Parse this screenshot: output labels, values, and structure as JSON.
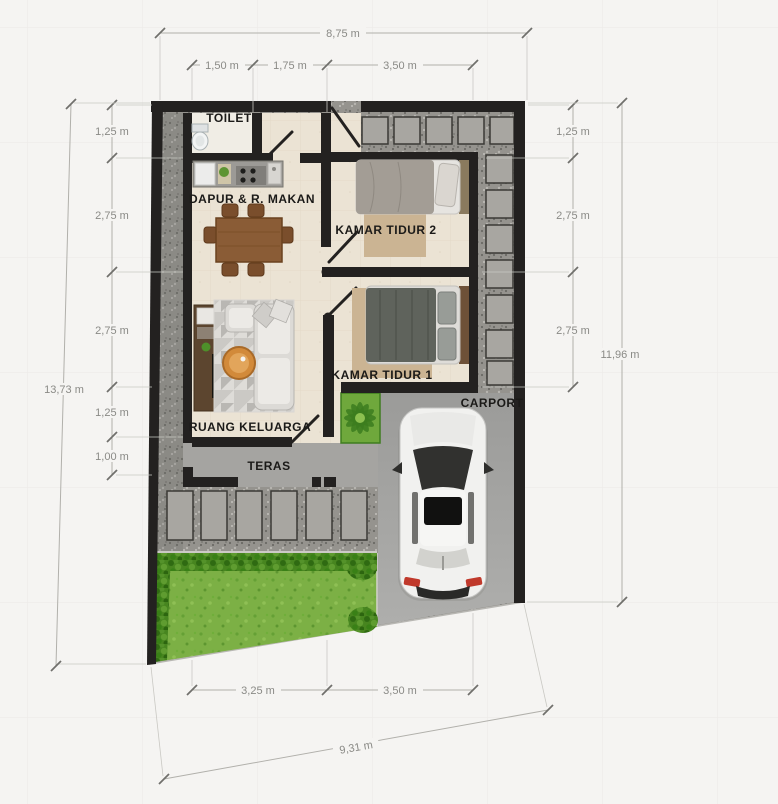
{
  "rooms": {
    "toilet": "TOILET",
    "kitchen_dining": "DAPUR & R. MAKAN",
    "bedroom2": "KAMAR TIDUR 2",
    "bedroom1": "KAMAR TIDUR 1",
    "living": "RUANG KELUARGA",
    "terrace": "TERAS",
    "carport": "CARPORT"
  },
  "dimensions": {
    "top": {
      "total": "8,75 m",
      "seg1": "1,50 m",
      "seg2": "1,75 m",
      "seg3": "3,50 m"
    },
    "left": {
      "total": "13,73 m",
      "seg1": "1,25 m",
      "seg2": "2,75 m",
      "seg3": "2,75 m",
      "seg4": "1,25 m",
      "seg5": "1,00 m"
    },
    "right": {
      "total": "11,96 m",
      "seg1": "1,25 m",
      "seg2": "2,75 m",
      "seg3": "2,75 m"
    },
    "bottom": {
      "total": "9,31 m",
      "seg1": "3,25 m",
      "seg2": "3,50 m"
    }
  },
  "colors": {
    "background": "#f5f4f2",
    "wall": "#232120",
    "floor": "#ebe3d4",
    "gravel": "#95938e",
    "paver": "#a8a6a1",
    "concrete_terrace": "#a5a4a1",
    "concrete_carport": "#a0a09e",
    "grass": "#7cb045",
    "hedge": "#47851f",
    "planter": "#6fa83c",
    "rug_bedroom": "#cbb493",
    "table_wood": "#8a5c36",
    "sofa": "#dcdad6",
    "coffee_table": "#d28a3a",
    "car_body": "#f1f1ef",
    "taillight": "#c0392b",
    "dimension_line": "#b1b0ab",
    "dimension_text": "#8a8a86",
    "label_text": "#1b1a18"
  }
}
